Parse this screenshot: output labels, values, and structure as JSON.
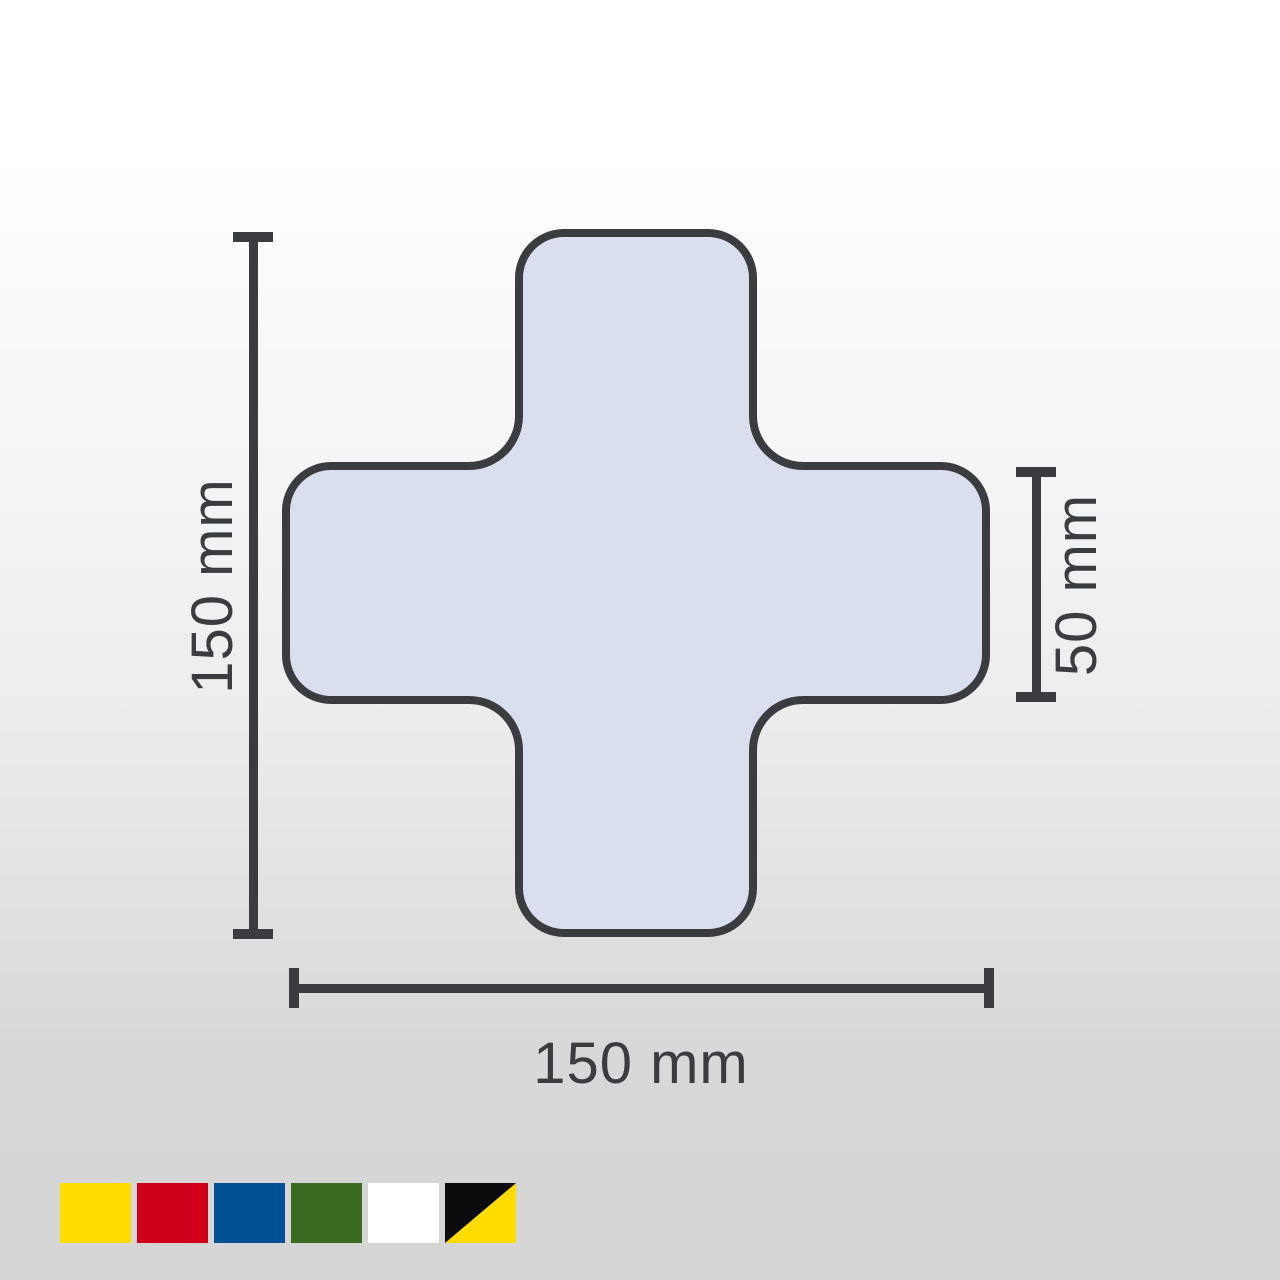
{
  "diagram": {
    "shape": "cross-floor-marking",
    "cross": {
      "fill": "#D9DFEC",
      "stroke": "#3A3C40"
    },
    "annotation": {
      "color": "#3A3C40"
    },
    "dimensions": {
      "height_label": "150 mm",
      "width_label": "150 mm",
      "arm_width_label": "50 mm"
    }
  },
  "color_options": {
    "items": [
      {
        "label": "yellow",
        "color": "#FFDC00"
      },
      {
        "label": "red",
        "color": "#D10019"
      },
      {
        "label": "blue",
        "color": "#005094"
      },
      {
        "label": "green",
        "color": "#3A6B1E"
      },
      {
        "label": "white",
        "color": "#FFFFFF"
      },
      {
        "label": "black-yellow",
        "primary": "#0B0B0E",
        "secondary": "#FFDC00"
      }
    ]
  }
}
